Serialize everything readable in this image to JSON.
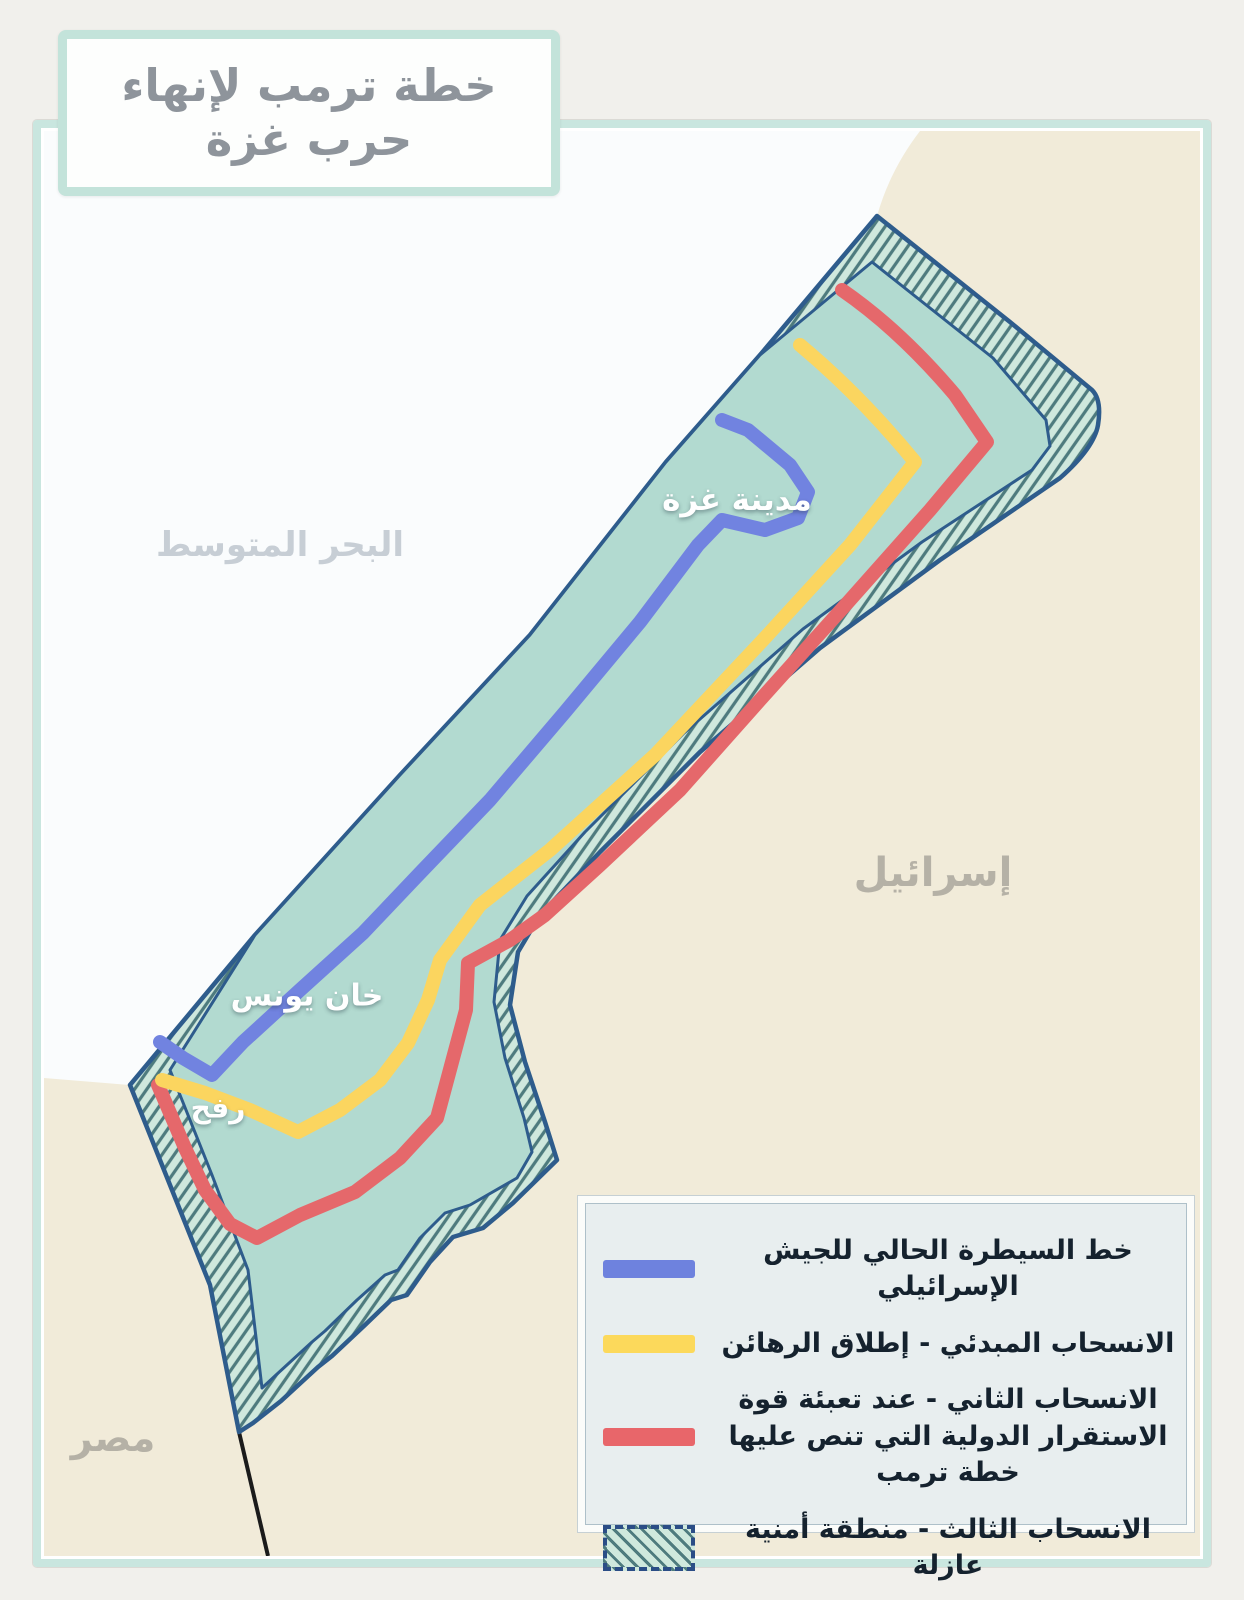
{
  "title": "خطة ترمب لإنهاء حرب غزة",
  "map_labels": {
    "sea": "البحر المتوسط",
    "israel": "إسرائيل",
    "egypt": "مصر",
    "gaza_city": "مدينة غزة",
    "khan_younis": "خان يونس",
    "rafah": "رفح"
  },
  "legend": {
    "items": [
      {
        "swatch": "blue-line",
        "label": "خط السيطرة الحالي للجيش الإسرائيلي"
      },
      {
        "swatch": "yellow-line",
        "label": "الانسحاب المبدئي - إطلاق الرهائن"
      },
      {
        "swatch": "red-line",
        "label": "الانسحاب الثاني - عند تعبئة قوة الاستقرار الدولية التي تنص عليها خطة ترمب"
      },
      {
        "swatch": "hatched-area",
        "label": "الانسحاب الثالث - منطقة أمنية عازلة"
      }
    ]
  },
  "colors": {
    "israeli_control_line": "#7183e0",
    "initial_withdrawal_line": "#fbd55f",
    "second_withdrawal_line": "#e5686b",
    "buffer_zone_hatch": "#4e7b7e",
    "gaza_fill": "#b2dad0",
    "buffer_fill": "#cfe8dd",
    "border_stroke": "#2e5c8c",
    "israel_egypt_land": "#f1ebd9",
    "sea": "#fafcfd"
  }
}
